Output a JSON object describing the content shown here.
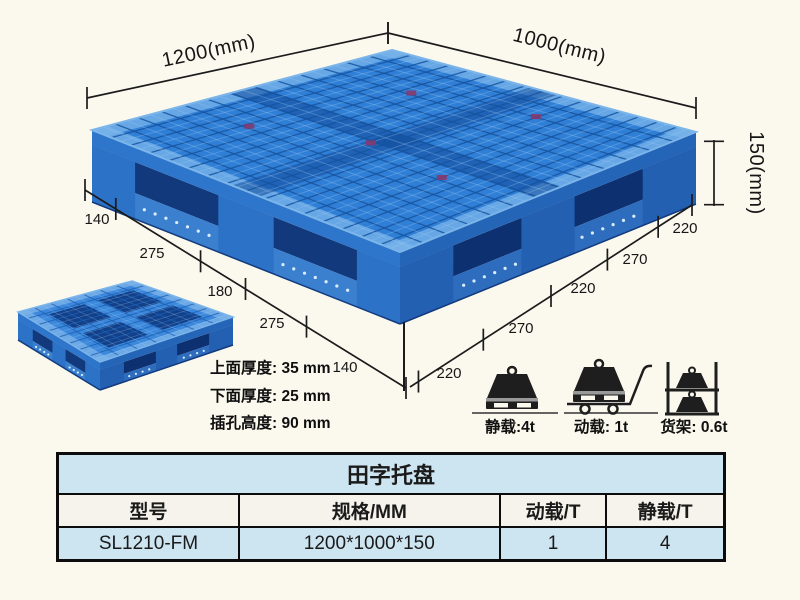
{
  "colors": {
    "pallet_blue": "#307fd6",
    "pallet_dark_blue": "#11397c",
    "table_blue": "#cde4f1",
    "background": "#fbf9ee"
  },
  "diagram": {
    "width_label": "1200(mm)",
    "depth_label": "1000(mm)",
    "height_label": "150(mm)",
    "left_chain": [
      "140",
      "275",
      "180",
      "275",
      "140"
    ],
    "right_chain": [
      "220",
      "270",
      "220",
      "270",
      "220"
    ],
    "thickness_notes": [
      "上面厚度: 35 mm",
      "下面厚度: 25 mm",
      "插孔高度: 90 mm"
    ]
  },
  "load_ratings": [
    {
      "icon": "static-load-icon",
      "label": "静载:4t"
    },
    {
      "icon": "dynamic-load-icon",
      "label": "动载: 1t"
    },
    {
      "icon": "rack-load-icon",
      "label": "货架: 0.6t"
    }
  ],
  "table": {
    "title": "田字托盘",
    "headers": [
      "型号",
      "规格/MM",
      "动载/T",
      "静载/T"
    ],
    "rows": [
      [
        "SL1210-FM",
        "1200*1000*150",
        "1",
        "4"
      ]
    ]
  }
}
